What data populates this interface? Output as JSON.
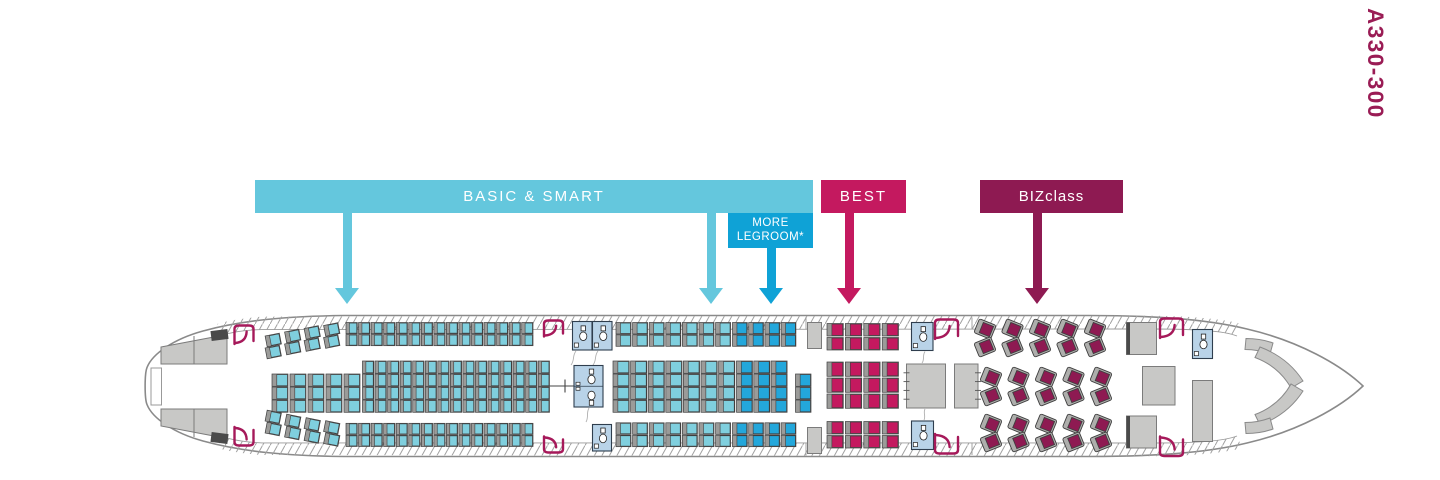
{
  "aircraft_model_label": "A330-300",
  "fare_bands": {
    "basic_smart": {
      "label": "BASIC & SMART",
      "color": "#64C7DD"
    },
    "more_legroom": {
      "label_line1": "MORE",
      "label_line2": "LEGROOM*",
      "color": "#0FA2D6"
    },
    "best": {
      "label": "BEST",
      "color": "#C4195F"
    },
    "bizclass": {
      "label": "BIZclass",
      "color": "#8E1A52"
    }
  },
  "seat_totals": {
    "economy_basic_smart": 207,
    "more_legroom": 31,
    "best": 28,
    "bizclass": 30
  },
  "colors": {
    "economy": "#7FCFDE",
    "more_legroom_seat": "#23A7DB",
    "best_seat": "#C4195F",
    "biz_seat": "#8E1A52",
    "biz_shell": "#AEAEAC",
    "seat_frame": "#9B9B99",
    "seat_border": "#3F3F3F",
    "model_label": "#9A1C55",
    "door": "#A6195A",
    "lavatory": "#B9D3E8",
    "lavatory_line": "#2F3E4E",
    "galley": "#C8C8C6",
    "galley_line": "#7B7B7B",
    "outline": "#8A8A8A"
  },
  "seat_map": {
    "blocks": [
      {
        "name": "economy-rear-top-slanted",
        "color": "economy",
        "x": 266,
        "pitch": 19.5,
        "cols": 4,
        "rows": [
          322.5,
          334.5
        ],
        "w": 14.5,
        "h": 11,
        "rotate": -11,
        "col_dy": [
          12,
          8,
          4.5,
          1.5
        ]
      },
      {
        "name": "economy-rear-top",
        "color": "economy",
        "x": 346,
        "pitch": 12.55,
        "cols": 15,
        "rows": [
          322.5,
          334.5
        ],
        "w": 11.3,
        "h": 11.2
      },
      {
        "name": "economy-rear-middle-3",
        "color": "economy",
        "x": 272,
        "pitch": 18,
        "cols": 5,
        "rows": [
          374,
          387,
          400
        ],
        "w": 16,
        "h": 12.3
      },
      {
        "name": "economy-rear-middle-4",
        "color": "economy",
        "x": 362.5,
        "pitch": 12.55,
        "cols": 15,
        "rows": [
          361,
          374,
          387,
          400
        ],
        "w": 11.3,
        "h": 12.3
      },
      {
        "name": "economy-rear-bottom-slanted",
        "color": "economy",
        "x": 266,
        "pitch": 19.5,
        "cols": 4,
        "rows": [
          423.5,
          435.5
        ],
        "w": 14.5,
        "h": 11,
        "rotate": 11,
        "col_dy": [
          -12,
          -8,
          -4.5,
          -1.5
        ]
      },
      {
        "name": "economy-rear-bottom",
        "color": "economy",
        "x": 346,
        "pitch": 12.55,
        "cols": 15,
        "rows": [
          423.3,
          435.3
        ],
        "w": 11.3,
        "h": 11.2
      },
      {
        "name": "economy-front-top",
        "color": "economy",
        "x": 616,
        "pitch": 16.6,
        "cols": 7,
        "rows": [
          322.5,
          334.8
        ],
        "w": 15,
        "h": 11.5
      },
      {
        "name": "more-legroom-front-top",
        "color": "more_legroom_seat",
        "x": 732.5,
        "pitch": 16.2,
        "cols": 4,
        "rows": [
          322.5,
          334.8
        ],
        "w": 14.8,
        "h": 11.5
      },
      {
        "name": "economy-front-middle",
        "color": "economy",
        "x": 613,
        "pitch": 17.6,
        "cols": 7,
        "rows": [
          361,
          374,
          387,
          400
        ],
        "w": 16.2,
        "h": 12.3
      },
      {
        "name": "more-legroom-front-middle",
        "color": "more_legroom_seat",
        "x": 736.5,
        "pitch": 17.3,
        "cols": 3,
        "rows": [
          361,
          374,
          387,
          400
        ],
        "w": 16,
        "h": 12.3
      },
      {
        "name": "more-legroom-mini-column",
        "color": "more_legroom_seat",
        "x": 795.5,
        "pitch": 17,
        "cols": 1,
        "rows": [
          374,
          387,
          400
        ],
        "w": 15.5,
        "h": 12.3
      },
      {
        "name": "economy-front-bottom",
        "color": "economy",
        "x": 616,
        "pitch": 16.6,
        "cols": 7,
        "rows": [
          422.8,
          435.2
        ],
        "w": 15,
        "h": 11.5
      },
      {
        "name": "more-legroom-front-bottom",
        "color": "more_legroom_seat",
        "x": 732.5,
        "pitch": 16.2,
        "cols": 4,
        "rows": [
          422.8,
          435.2
        ],
        "w": 14.8,
        "h": 11.5
      },
      {
        "name": "best-top",
        "color": "best_seat",
        "x": 827,
        "pitch": 18.4,
        "cols": 4,
        "rows": [
          323.5,
          337.5
        ],
        "w": 16.3,
        "h": 12.5
      },
      {
        "name": "best-middle",
        "color": "best_seat",
        "x": 827,
        "pitch": 18.4,
        "cols": 4,
        "rows": [
          362,
          378,
          394
        ],
        "w": 16.3,
        "h": 14.3
      },
      {
        "name": "best-bottom",
        "color": "best_seat",
        "x": 827,
        "pitch": 18.4,
        "cols": 4,
        "rows": [
          421.5,
          435.5
        ],
        "w": 16.3,
        "h": 12.5
      }
    ],
    "biz": {
      "shell": {
        "w": 18,
        "h": 15
      },
      "cushion": {
        "w": 11,
        "h": 11
      },
      "banks": [
        {
          "name": "biz-top",
          "columns": [
            985,
            1012.5,
            1040,
            1067.5,
            1095
          ],
          "seats": [
            {
              "cy": 329,
              "rot": 22
            },
            {
              "cy": 347,
              "rot": -22
            }
          ]
        },
        {
          "name": "biz-middle",
          "columns": [
            991,
            1018.5,
            1046,
            1073.5,
            1101
          ],
          "seats": [
            {
              "cy": 377,
              "rot": 22
            },
            {
              "cy": 396,
              "rot": -22
            }
          ]
        },
        {
          "name": "biz-bottom",
          "columns": [
            991,
            1018.5,
            1046,
            1073.5,
            1101
          ],
          "seats": [
            {
              "cy": 424,
              "rot": 22
            },
            {
              "cy": 442,
              "rot": -22
            }
          ]
        }
      ]
    }
  },
  "aircraft": {
    "fuselage_path": "M1363,386 C1341,365 1299,341 1247,329 C1204,318.5 1149,315.5 1088,315.5 L344,315.5 C288,316.2 243,320 203,331 C174,339 152.5,353.5 147,367.5 C144.5,373.5 144.5,398.5 147,404.5 C152.5,418.5 174,433 203,441 C243,452 288,455.8 344,456.5 L1088,456.5 C1149,456.5 1204,453.5 1247,443 C1299,431 1341,407 1363,386 Z",
    "band_paths": [
      "M262,316.6 L1152,315.7 L1152,329 L262,329.6 Z",
      "M262,442.9 L1152,442.9 L1152,456.2 L262,455 Z",
      "M1152,315.7 C1200,316 1231,320.5 1242,324 L1237,336 C1224,330.8 1196,329 1152,329 Z",
      "M1152,456.2 C1200,456 1231,451.5 1242,448 L1237,436 C1224,441.2 1196,443 1152,443 Z",
      "M262,316.6 C243,318.3 228,320.6 217,324 L222,335.5 C233,331.7 247,329.8 262,329.6 Z",
      "M262,455 C243,453.6 228,451.3 217,448 L222,436.4 C233,440.2 247,442.2 262,442.9 Z"
    ],
    "band_lines": [
      "M262,329.6 L1152,329",
      "M262,442.9 L1152,443",
      "M1152,329 C1196,329 1224,330.8 1237,336",
      "M1152,443 C1196,443 1224,441.2 1237,436",
      "M262,329.6 C247,329.8 233,331.7 222,335.5",
      "M262,442.9 C247,442.2 233,440.2 222,436.4"
    ],
    "partition_lines": [
      "M806,317 L806,329.5",
      "M806,443 L806,455.5",
      "M972,317.5 L972,329.5",
      "M972,443 L972,455"
    ],
    "curtain_lines": [
      "M576,351 C572,356 575,360 571,365",
      "M598,351 C594,356 597,360 593,365",
      "M589,408 C586,413 589,417 586,422",
      "M925,351.5 C922,356 925,359 922,363",
      "M925,409 C923,413 926,416 924,420"
    ],
    "centerline_paths": [
      "M543,386 L576,386",
      "M565,379.5 L565,392.5"
    ],
    "tail_box": {
      "x": 151,
      "y": 368,
      "w": 10.5,
      "h": 37
    },
    "slabs": [
      {
        "x": 211,
        "y": 330,
        "w": 17,
        "h": 10,
        "rot": -7
      },
      {
        "x": 211,
        "y": 433,
        "w": 17,
        "h": 10,
        "rot": 7
      }
    ],
    "galleys": [
      {
        "name": "galley-tail-top",
        "d": "M161,347 L227,334.5 L227,364 L161,364 Z",
        "divider": [
          194,
          336,
          194,
          364
        ]
      },
      {
        "name": "galley-tail-bottom",
        "d": "M161,409 L227,409 L227,438.5 L161,426 Z",
        "divider": [
          194,
          409,
          194,
          437
        ]
      },
      {
        "name": "galley-front-economy-top",
        "x": 807.5,
        "y": 322.5,
        "w": 14,
        "h": 26
      },
      {
        "name": "galley-front-economy-bottom",
        "x": 807.5,
        "y": 427.5,
        "w": 14,
        "h": 26
      },
      {
        "name": "galley-aft-bizclass",
        "x": 906.5,
        "y": 364,
        "w": 39,
        "h": 44,
        "ticks": "left"
      },
      {
        "name": "galley-fwd-door2",
        "x": 954.5,
        "y": 364,
        "w": 23.5,
        "h": 44,
        "ticks": "right"
      },
      {
        "name": "galley-fwd-bizclass-top",
        "x": 1126.5,
        "y": 322.5,
        "w": 30,
        "h": 32,
        "darkEdge": true
      },
      {
        "name": "galley-fwd-bizclass-bottom",
        "x": 1126.5,
        "y": 416,
        "w": 30,
        "h": 32,
        "darkEdge": true
      },
      {
        "name": "galley-fwd-bizclass-mid",
        "x": 1142.5,
        "y": 366.5,
        "w": 32.5,
        "h": 38.5
      },
      {
        "name": "galley-nose",
        "x": 1192.5,
        "y": 380.5,
        "w": 20,
        "h": 61
      }
    ],
    "lavatories": [
      {
        "x": 572.5,
        "y": 321.5,
        "w": 19.5,
        "h": 28.5
      },
      {
        "x": 592.5,
        "y": 321.5,
        "w": 19.5,
        "h": 28.5
      },
      {
        "x": 574,
        "y": 365.5,
        "w": 29,
        "h": 41.5,
        "double": true
      },
      {
        "x": 592.5,
        "y": 424.5,
        "w": 19,
        "h": 26.5
      },
      {
        "x": 911.5,
        "y": 322.5,
        "w": 21.5,
        "h": 28
      },
      {
        "x": 911.5,
        "y": 421,
        "w": 22,
        "h": 28.5
      },
      {
        "x": 1192.5,
        "y": 329.5,
        "w": 20,
        "h": 29
      }
    ],
    "doors": [
      {
        "x": 233,
        "y": 324,
        "w": 22,
        "h": 20
      },
      {
        "x": 233,
        "y": 427,
        "w": 22,
        "h": 20,
        "flip": true
      },
      {
        "x": 542.5,
        "y": 319,
        "w": 22,
        "h": 17.5
      },
      {
        "x": 542.5,
        "y": 436.5,
        "w": 22,
        "h": 17.5,
        "flip": true
      },
      {
        "x": 933.5,
        "y": 318,
        "w": 26,
        "h": 21
      },
      {
        "x": 933.5,
        "y": 434,
        "w": 26,
        "h": 21,
        "flip": true
      },
      {
        "x": 1158.5,
        "y": 317,
        "w": 26,
        "h": 21
      },
      {
        "x": 1158.5,
        "y": 436.5,
        "w": 26,
        "h": 21,
        "flip": true
      }
    ],
    "cockpit_paths": [
      "M1246,338.5 Q1261,338.5 1273,343 L1270,354 Q1258,349.5 1245,349.5 Z",
      "M1260,347 Q1288,357.5 1303,381 L1291,388 Q1279,366.5 1255,357.5 Z",
      "M1260,425 Q1288,414.5 1303,391 L1291,384 Q1279,405.5 1255,414.5 Z",
      "M1246,433.5 Q1261,433.5 1273,429 L1270,418 Q1258,422.5 1245,422.5 Z"
    ]
  }
}
